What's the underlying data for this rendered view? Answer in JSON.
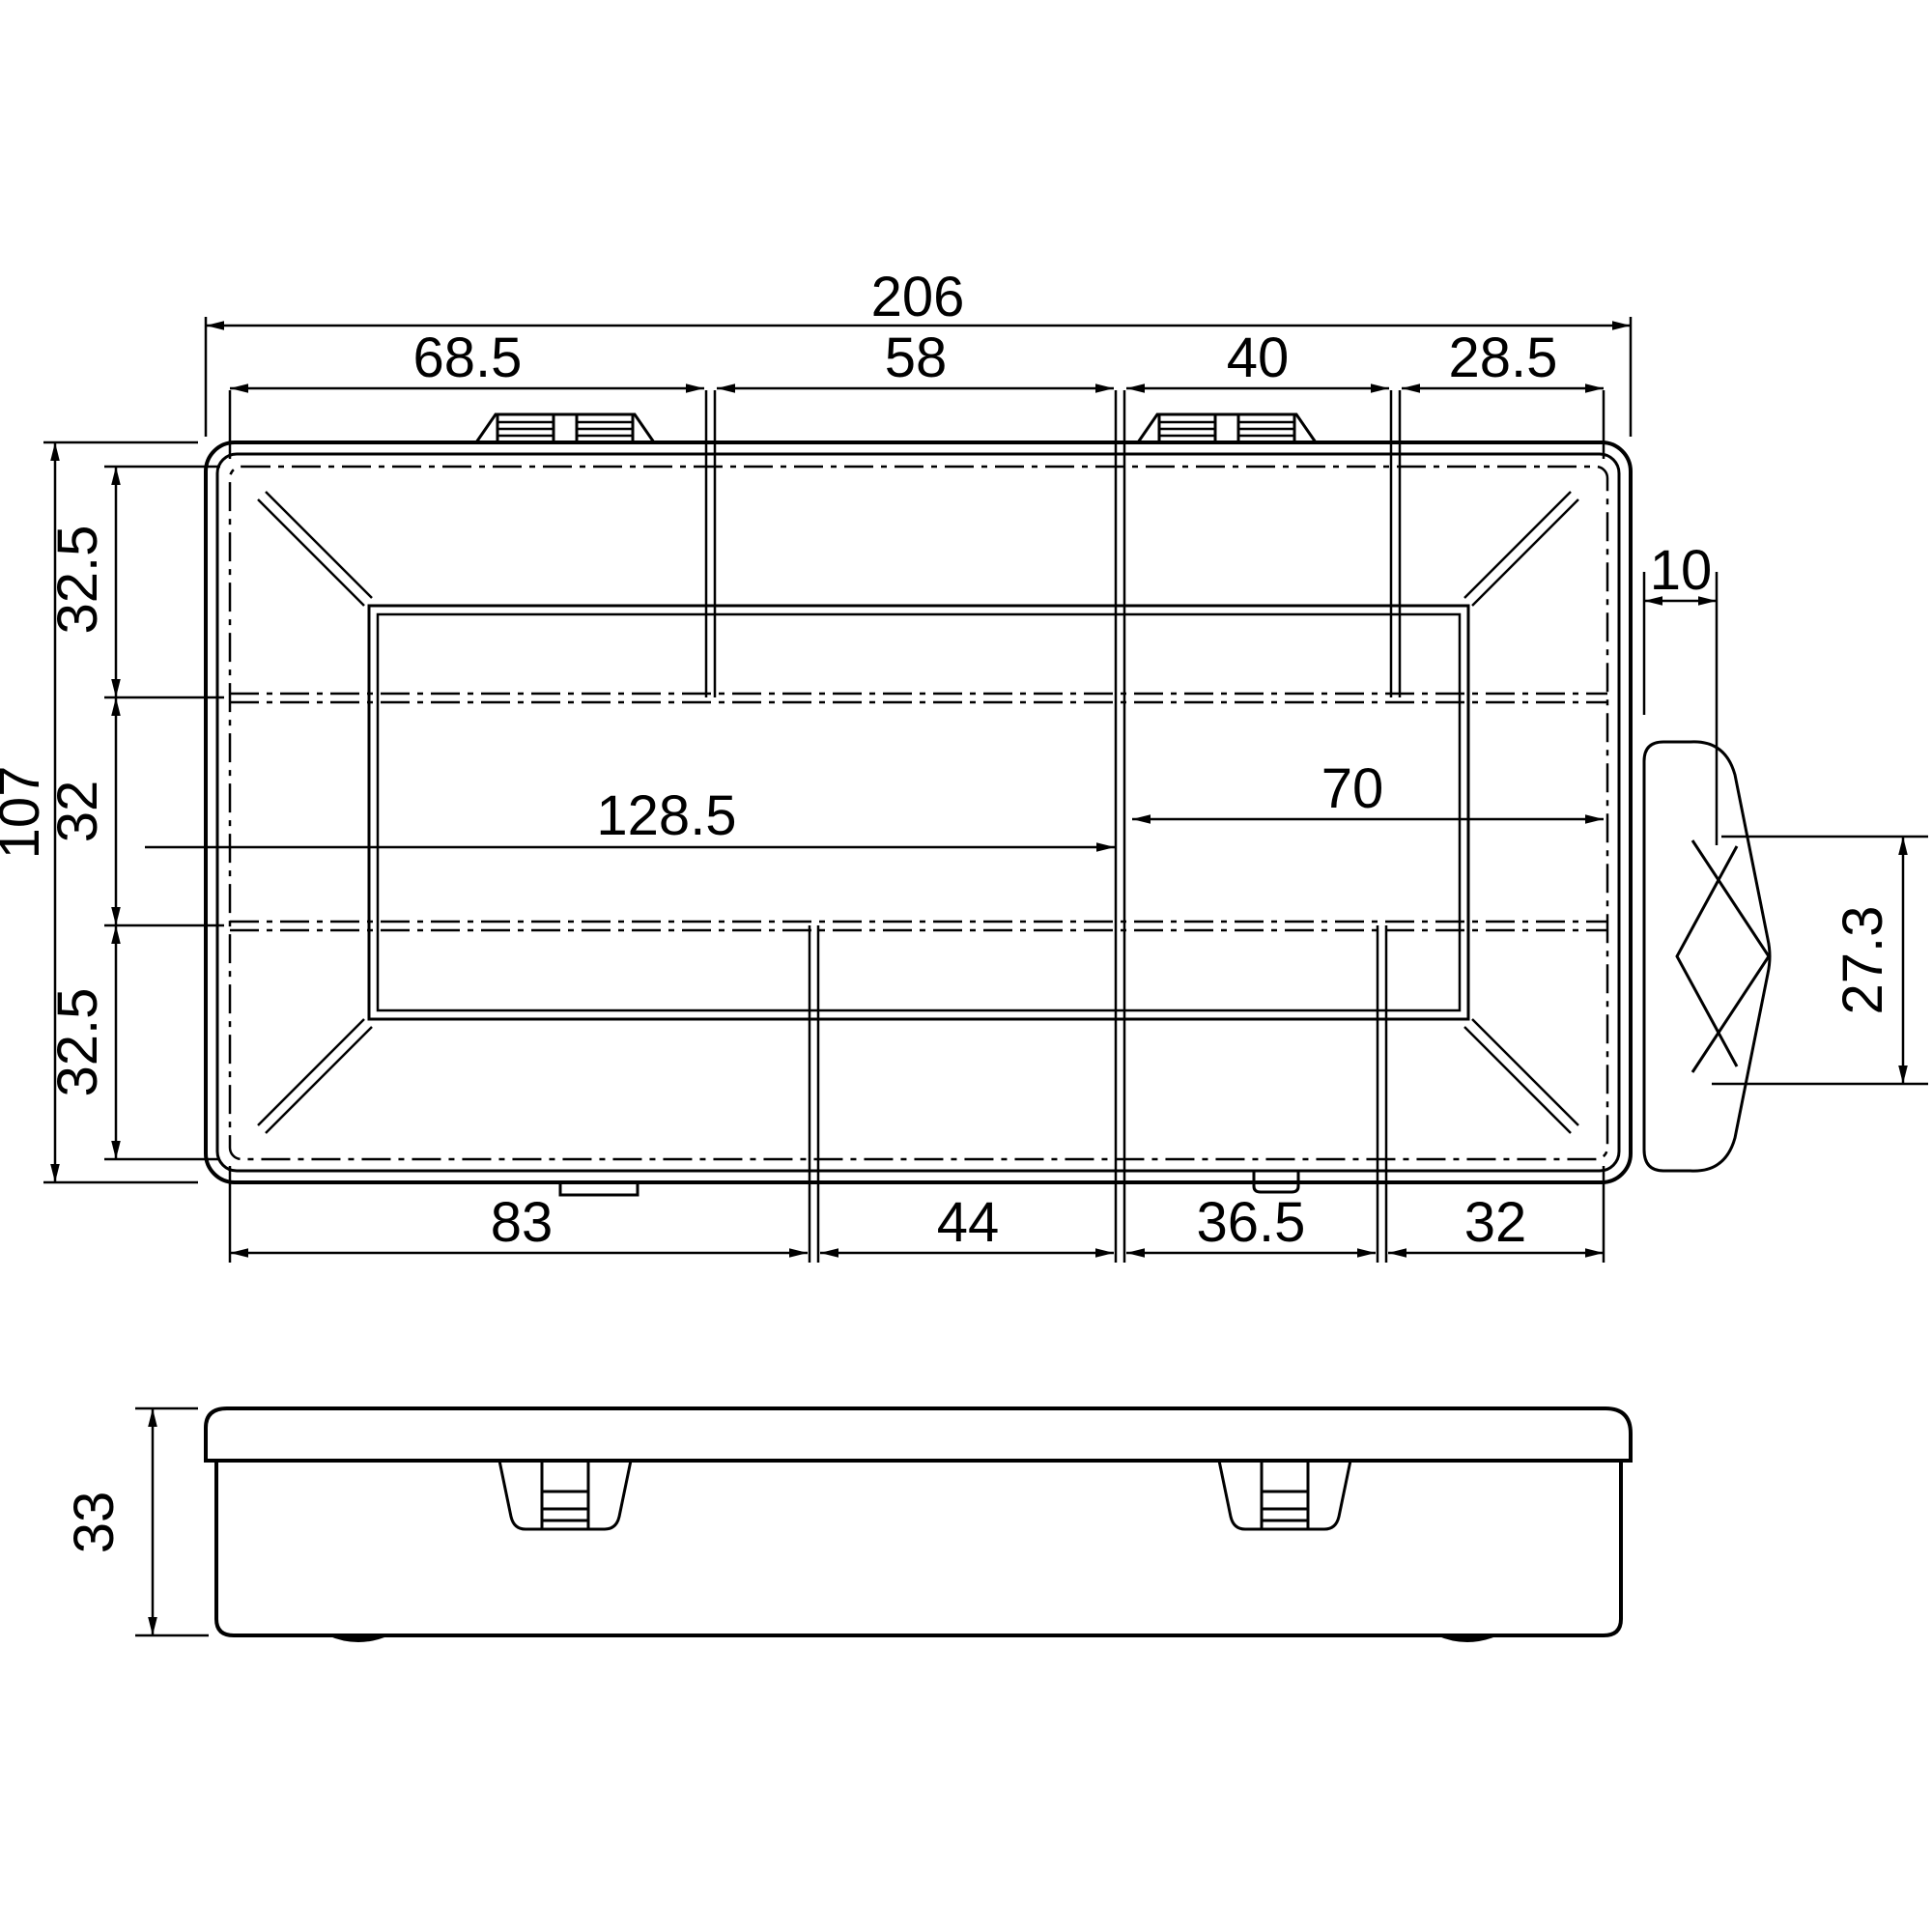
{
  "drawing": {
    "kind": "technical-dimension-drawing",
    "subject": "organizer-box",
    "views": {
      "top_view": "top view",
      "side_view": "side view"
    },
    "colors": {
      "line": "#000000",
      "background": "#ffffff"
    },
    "dims": {
      "total_width": "206",
      "top_segments": [
        "68.5",
        "58",
        "40",
        "28.5"
      ],
      "total_depth": "107",
      "left_segments": [
        "32.5",
        "32",
        "32.5"
      ],
      "inner_width_left": "128.5",
      "inner_width_right": "70",
      "latch_depth": "10",
      "latch_height": "27.3",
      "bottom_segments": [
        "83",
        "44",
        "36.5",
        "32"
      ],
      "box_height": "33"
    }
  }
}
